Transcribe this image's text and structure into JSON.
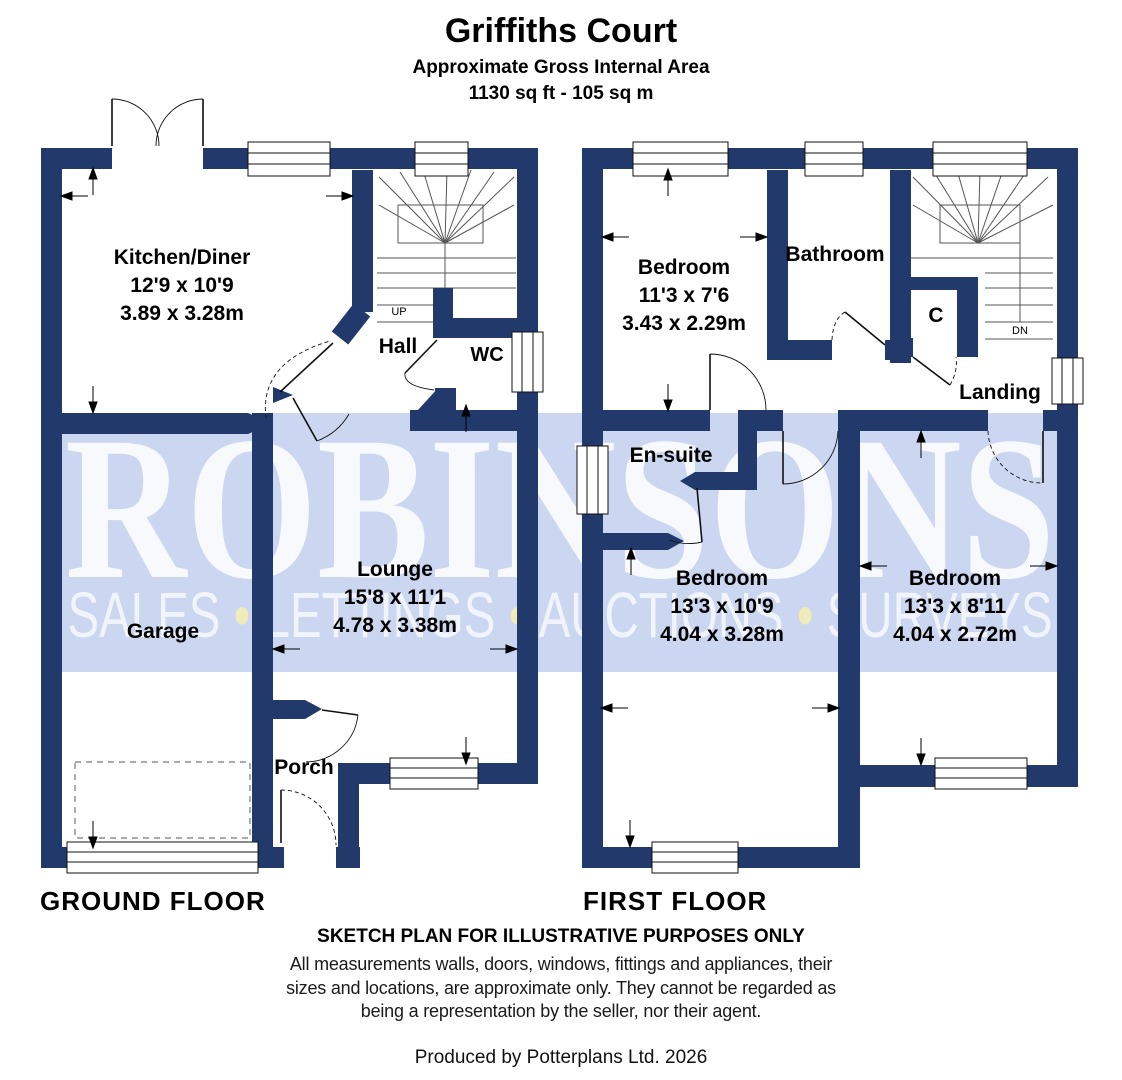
{
  "title": {
    "name": "Griffiths Court",
    "subtitle": "Approximate Gross Internal Area",
    "area": "1130 sq ft - 105 sq m"
  },
  "watermark": {
    "brand": "ROBINSONS",
    "dot": "•",
    "words": [
      "SALES",
      "LETTINGS",
      "AUCTIONS",
      "SURVEYS"
    ],
    "band_color": "#cbd7f0",
    "brand_color": "#f2f5fc",
    "dot_color": "#f0ecba"
  },
  "colors": {
    "wall": "#21396b",
    "line": "#111111",
    "stair_line": "#555555"
  },
  "ground_floor": {
    "label": "GROUND FLOOR",
    "stairs_label": "UP",
    "rooms": {
      "kitchen": {
        "name": "Kitchen/Diner",
        "imperial": "12'9 x 10'9",
        "metric": "3.89 x 3.28m"
      },
      "hall": {
        "name": "Hall"
      },
      "wc": {
        "name": "WC"
      },
      "lounge": {
        "name": "Lounge",
        "imperial": "15'8 x 11'1",
        "metric": "4.78 x 3.38m"
      },
      "garage": {
        "name": "Garage"
      },
      "porch": {
        "name": "Porch"
      }
    }
  },
  "first_floor": {
    "label": "FIRST FLOOR",
    "stairs_label": "DN",
    "rooms": {
      "bedroom1": {
        "name": "Bedroom",
        "imperial": "11'3 x 7'6",
        "metric": "3.43 x 2.29m"
      },
      "bathroom": {
        "name": "Bathroom"
      },
      "cupboard": {
        "name": "C"
      },
      "landing": {
        "name": "Landing"
      },
      "ensuite": {
        "name": "En-suite"
      },
      "bedroom2": {
        "name": "Bedroom",
        "imperial": "13'3 x 10'9",
        "metric": "4.04 x 3.28m"
      },
      "bedroom3": {
        "name": "Bedroom",
        "imperial": "13'3 x 8'11",
        "metric": "4.04 x 2.72m"
      }
    }
  },
  "footer": {
    "disclaimer_title": "SKETCH PLAN FOR ILLUSTRATIVE PURPOSES ONLY",
    "disclaimer_line1": "All measurements walls, doors, windows, fittings and appliances, their",
    "disclaimer_line2": "sizes and locations, are approximate only. They cannot be regarded as",
    "disclaimer_line3": "being a representation by the seller, nor their agent.",
    "credit": "Produced by Potterplans Ltd. 2026"
  }
}
